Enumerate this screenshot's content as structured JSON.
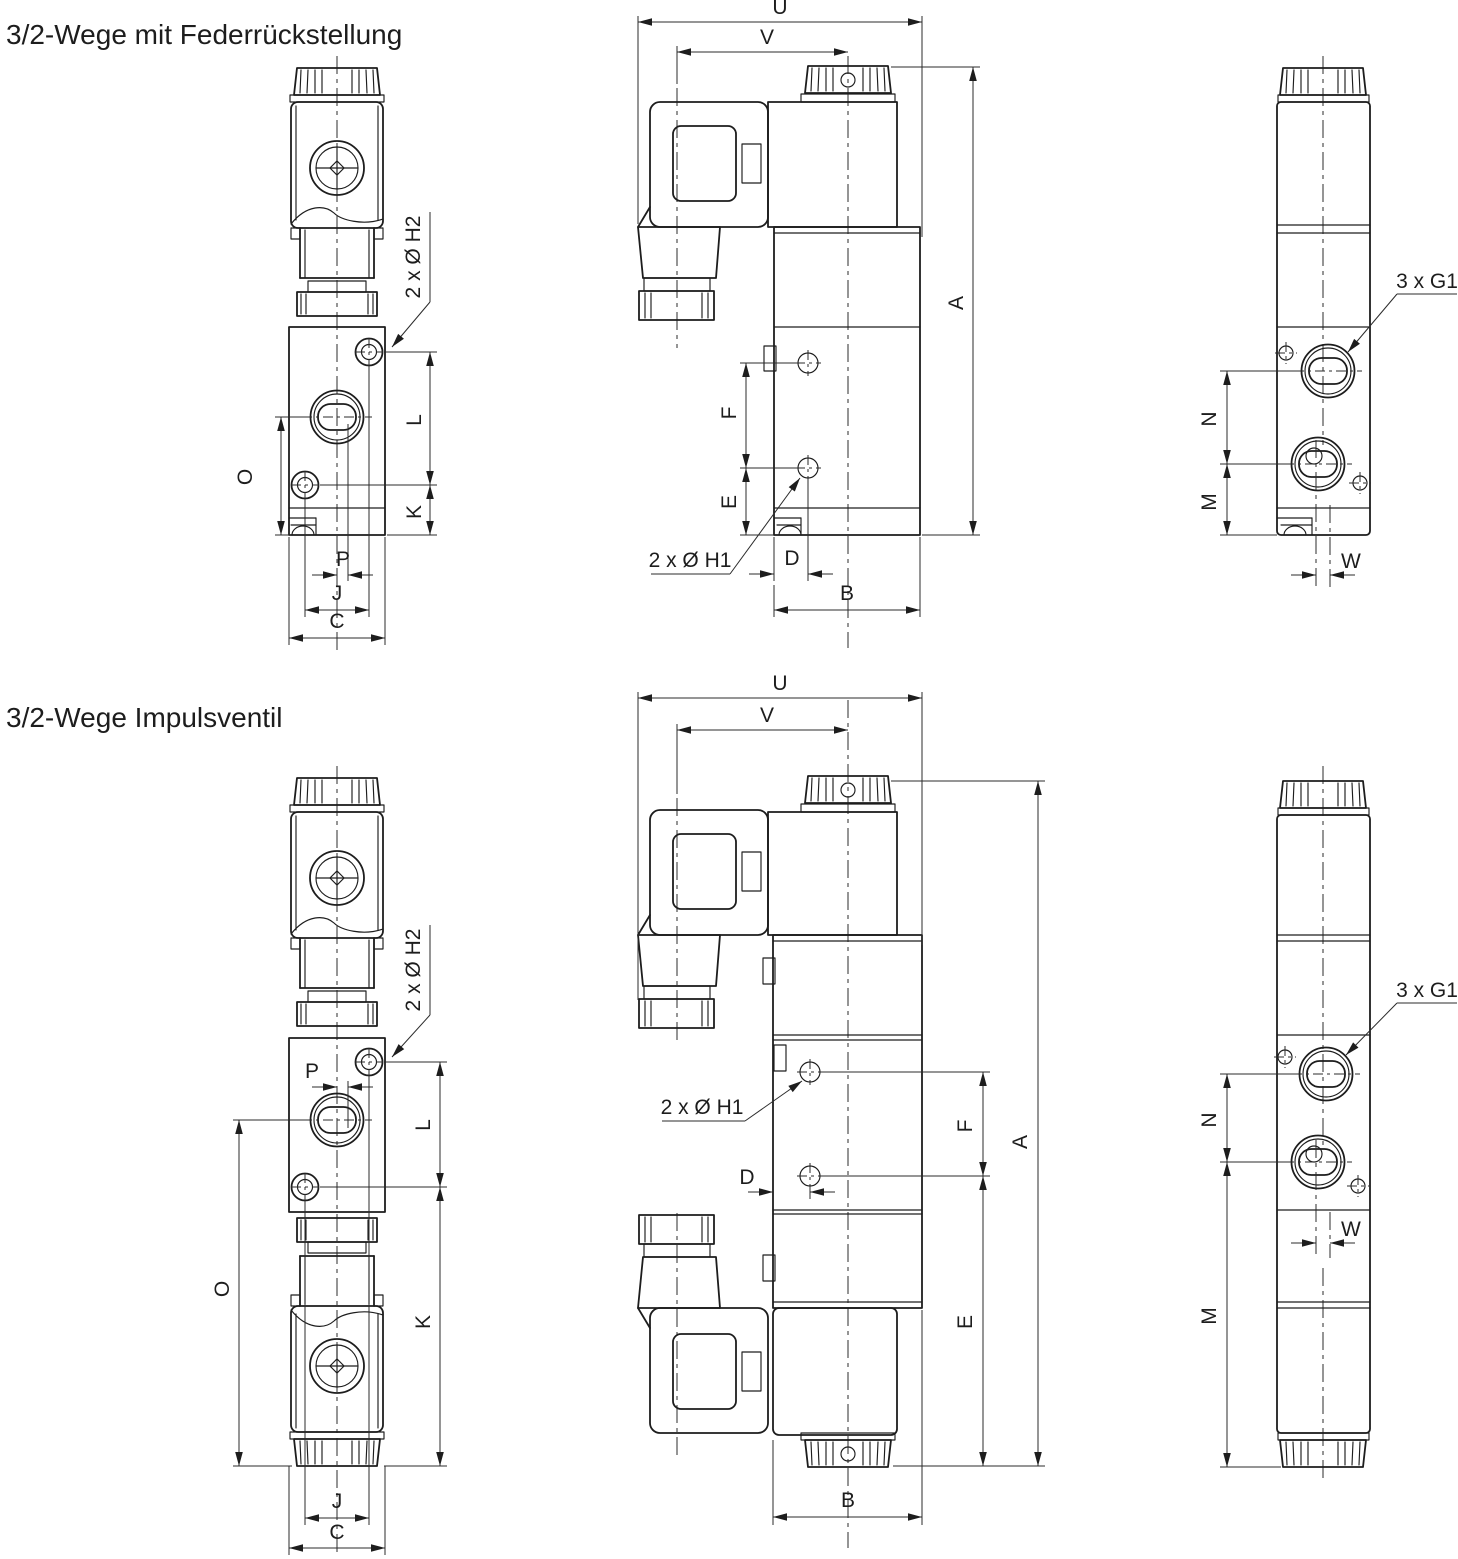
{
  "document": {
    "type": "technical-dimension-drawing",
    "subject": "3/2-way solenoid valves, three orthographic views per variant",
    "ink_color": "#1d1d1d",
    "background_color": "#ffffff"
  },
  "titles": {
    "row1": "3/2-Wege mit Federrückstellung",
    "row2": "3/2-Wege Impulsventil"
  },
  "views": {
    "r1_front": {
      "dims": {
        "h2": "2 x Ø H2",
        "o": "O",
        "l": "L",
        "k": "K",
        "p": "P",
        "j": "J",
        "c": "C"
      }
    },
    "r1_side": {
      "dims": {
        "u": "U",
        "v": "V",
        "a": "A",
        "b": "B",
        "d": "D",
        "e": "E",
        "f": "F",
        "h1": "2 x Ø H1"
      }
    },
    "r1_back": {
      "dims": {
        "g1": "3 x G1",
        "n": "N",
        "m": "M",
        "w": "W"
      }
    },
    "r2_front": {
      "dims": {
        "h2": "2 x Ø H2",
        "p": "P",
        "l": "L",
        "o": "O",
        "k": "K",
        "j": "J",
        "c": "C"
      }
    },
    "r2_side": {
      "dims": {
        "u": "U",
        "v": "V",
        "h1": "2 x Ø H1",
        "d": "D",
        "f": "F",
        "e": "E",
        "a": "A",
        "b": "B"
      }
    },
    "r2_back": {
      "dims": {
        "g1": "3 x G1",
        "n": "N",
        "m": "M",
        "w": "W"
      }
    }
  }
}
